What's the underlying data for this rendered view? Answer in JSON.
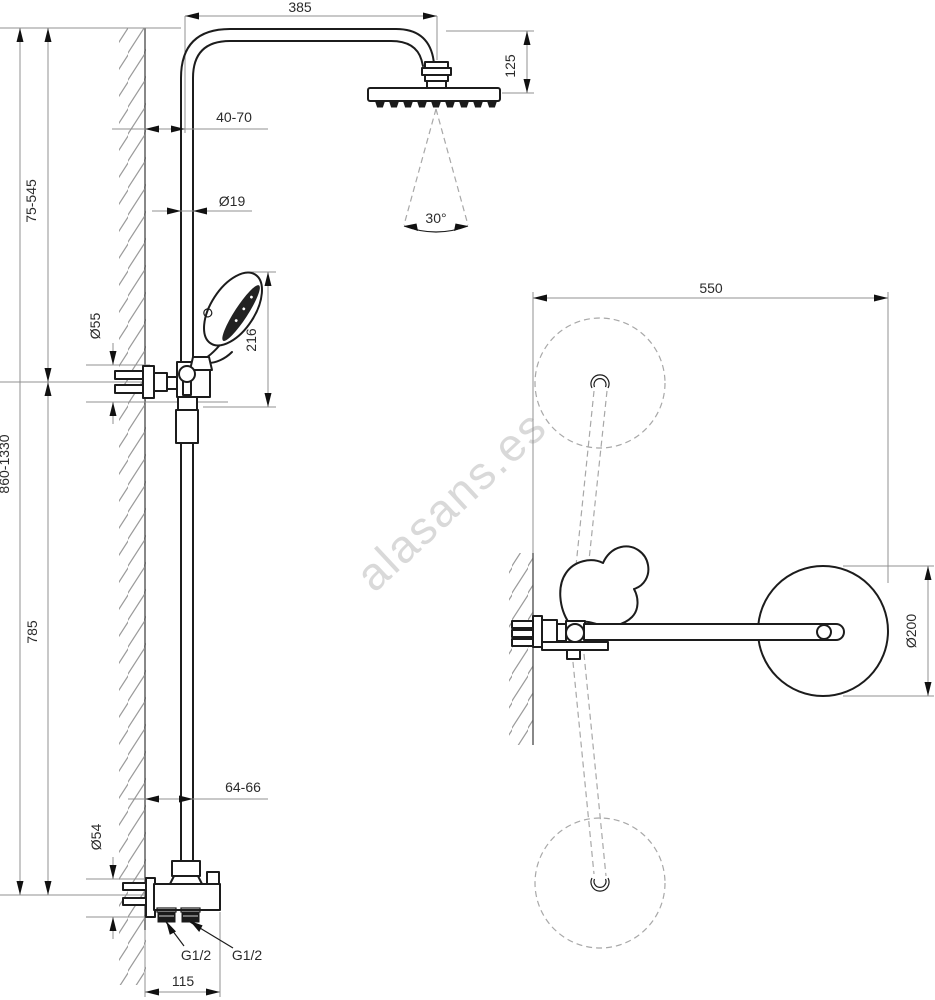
{
  "watermark": "alasans.es",
  "colors": {
    "line": "#1c1c1c",
    "dim_line": "#909090",
    "dashed": "#a8a8a8",
    "text": "#2b2b2b",
    "watermark": "#d9d9d9",
    "background": "#ffffff"
  },
  "front_view": {
    "dim_arm_reach": "385",
    "dim_head_height": "125",
    "dim_top_wall_clearance": "40-70",
    "dim_pipe_diameter": "Ø19",
    "dim_upper_height_range": "75-545",
    "dim_holder_diameter": "Ø55",
    "dim_hand_shower_length": "216",
    "dim_total_height_range": "860-1330",
    "dim_lower_height": "785",
    "dim_bottom_wall_clearance": "64-66",
    "dim_escutcheon_diameter": "Ø54",
    "label_inlet_left": "G1/2",
    "label_inlet_right": "G1/2",
    "dim_inlet_spacing": "115",
    "dim_spray_angle": "30°"
  },
  "side_view": {
    "dim_swivel_reach": "550",
    "dim_head_diameter": "Ø200"
  }
}
